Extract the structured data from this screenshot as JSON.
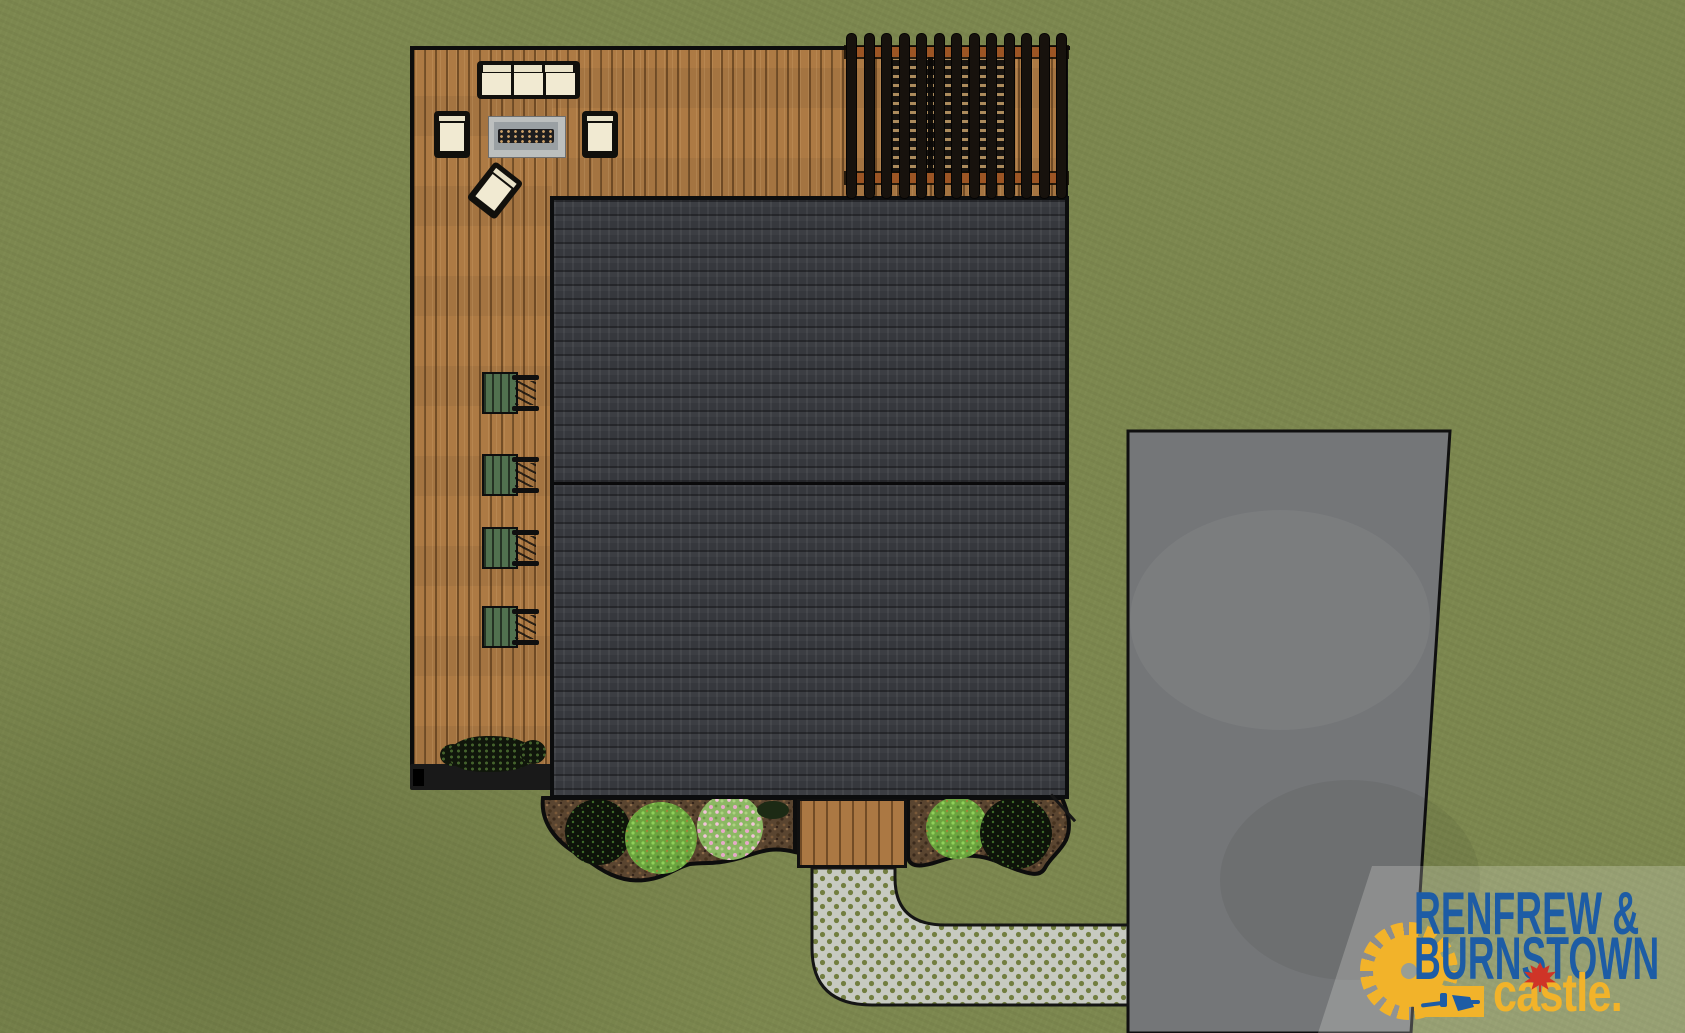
{
  "meta": {
    "title": "Backyard landscape design rendering (top-down site plan)"
  },
  "logo": {
    "line1": "RENFREW &",
    "line2": "BURNSTOWN",
    "line3": "castle."
  },
  "scene": {
    "view": "top-down rendering",
    "elements": {
      "lawn": "green grass lawn",
      "deck": "L-shaped brown wood deck with plank boards",
      "roof": "dark asphalt-shingle house roof with center ridge line",
      "pergola": "dark slatted pergola with dining furniture beneath",
      "lounge_set": "outdoor sofa, two armchairs, tilted accent chair, gray fire table",
      "adirondack_chairs": "four green slatted deck chairs in a row",
      "deck_shrub": "dark shrub row at deck bottom edge",
      "planting_beds": "two mulched planting beds with shrubs and pink-flowering plants",
      "stoop": "rear wood stoop landing",
      "walkway": "L-shaped permeable paver walkway with grass-dot grid",
      "driveway": "gray concrete driveway"
    }
  },
  "colors": {
    "grass": "#7c874f",
    "deck_wood": "#ad7a44",
    "roof": "#36383d",
    "driveway": "#747678",
    "walkway": "#c7cac1",
    "walkway_dot": "#727e40",
    "mulch": "#5a4530",
    "chair_green": "#51714f",
    "beam": "#9c5524",
    "cream": "#f1ead2",
    "outline": "#0d0d0d",
    "brand_blue": "#1d5ca5",
    "brand_yellow": "#f2b32a",
    "leaf_red": "#cf3427"
  }
}
